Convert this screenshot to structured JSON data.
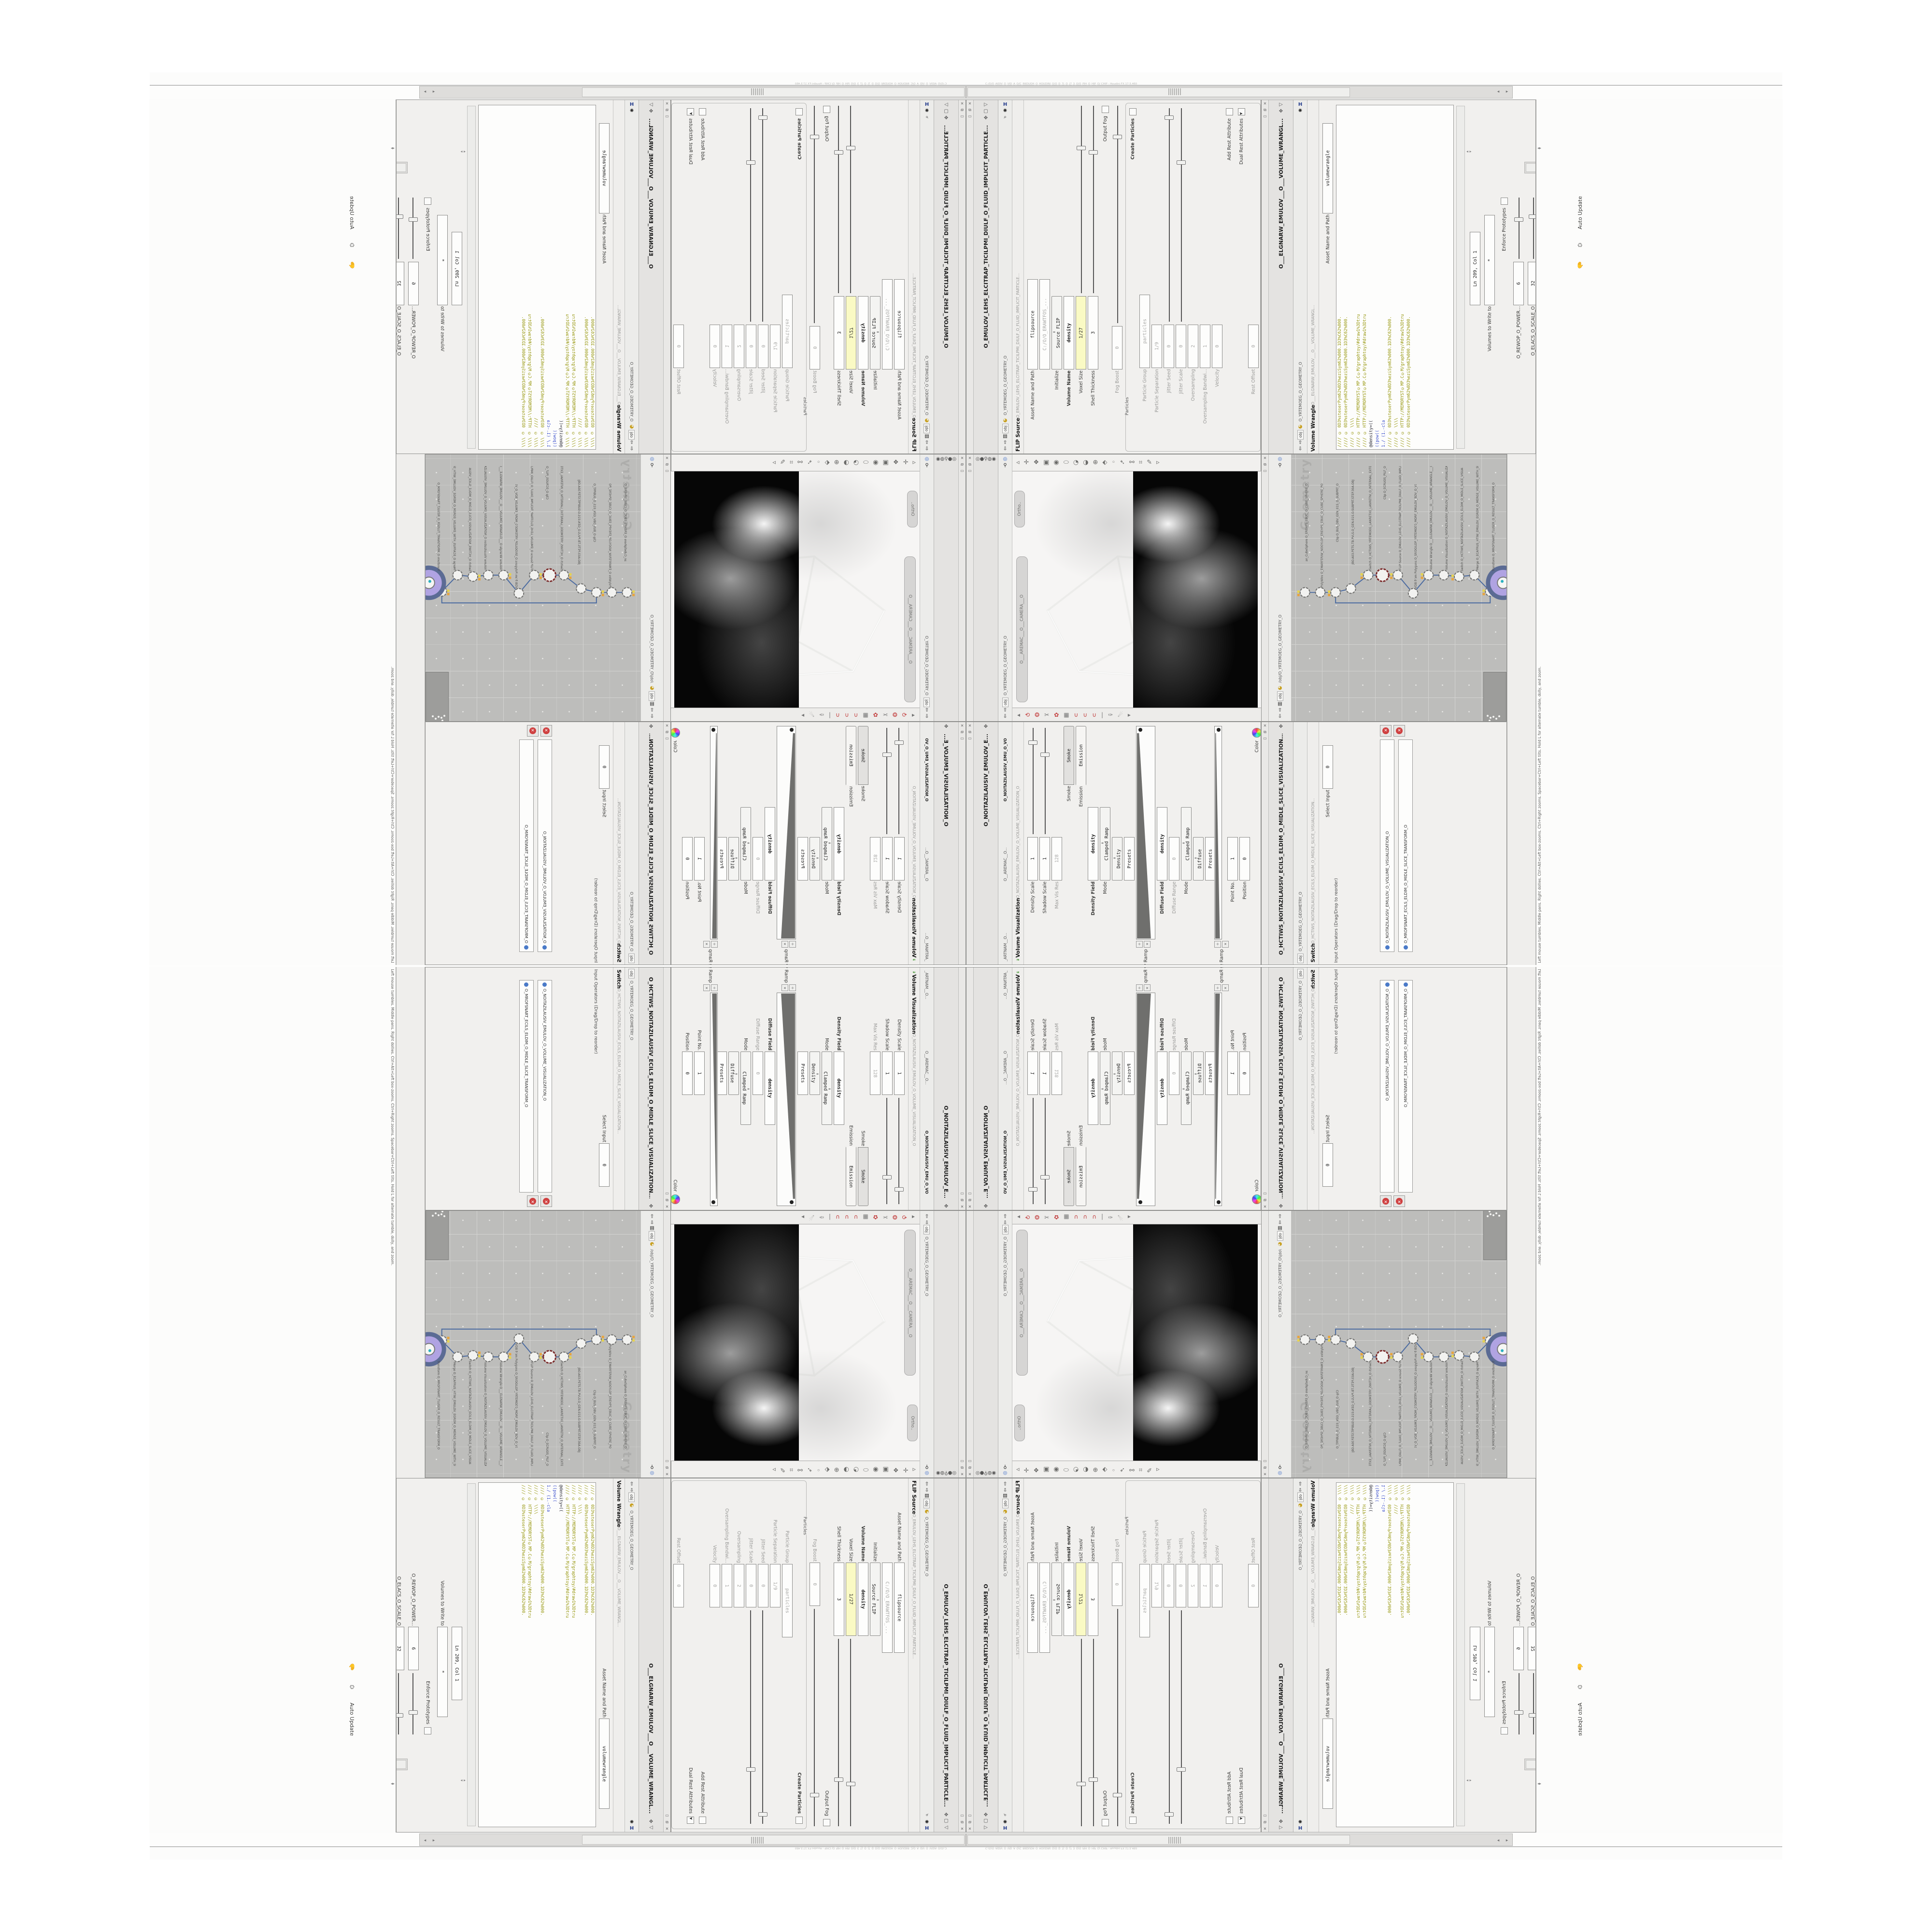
{
  "window": {
    "title": "C:/O/O_AIDIV_O_VID_A_O/C_INIDUOH_O_HOUDINI_O/O_D_7|_O_|7_3_O/O_PIH_O_HIP_O/ CHIP - Houdini FX 17.5.460",
    "auto_update": "Auto Update",
    "status_help": "Left mouse tumbles. Middle pans. Right dollies. Ctrl+Alt+Left box-zooms. Ctrl+Right zooms. Spacebar+Ctrl+Left tilts. Hold L for alternate tumble, dolly, and zoom.",
    "context": "obj",
    "geo_path": "O_YRTEMOEG_O_GEOMETRY_O",
    "net_path": "/obj/O_YRTEMOEG_O_GEOMETRY_O"
  },
  "flip": {
    "tab_long": "O_EMULOV_LEHS_ELCITRAP_TICILPMI_DIULF_O_FLUID_IMPLICIT_PARTICLE...",
    "node_title": "FLIP Source",
    "params_pre": [
      {
        "l": "Asset Name and Path",
        "v": "flipsource",
        "t": "tall"
      },
      {
        "l": "",
        "v": "C:/O/O_ERAWTFOS_...",
        "t": "tall dim"
      },
      {
        "l": "Initialize",
        "v": "Source FLIP",
        "t": "dd"
      },
      {
        "l": "Volume Name",
        "v": "density",
        "t": "b"
      },
      {
        "l": "Voxel Size",
        "v": "1/27",
        "t": "hl",
        "s": 1
      },
      {
        "l": "Shell Thickness",
        "v": "3",
        "t": "",
        "s": 1
      },
      {
        "l": "Output Fog",
        "v": "",
        "t": "chk"
      },
      {
        "l": "Fog Boost",
        "v": "0",
        "t": "dim short",
        "s": 1
      }
    ],
    "group_label": "Particles",
    "params_group": [
      {
        "l": "Create Particles",
        "v": "",
        "t": "chk b"
      },
      {
        "l": "Particle Group",
        "v": "particles",
        "t": "dim"
      },
      {
        "l": "Particle Separation",
        "v": "1/9",
        "t": "dim short"
      },
      {
        "l": "Jitter Seed",
        "v": "0",
        "t": "dim short",
        "s": 1
      },
      {
        "l": "Jitter Scale",
        "v": "0",
        "t": "dim short",
        "s": 1
      },
      {
        "l": "Oversampling",
        "v": "2",
        "t": "dim short"
      },
      {
        "l": "Oversampling Bandwi...",
        "v": "1",
        "t": "dim short"
      },
      {
        "l": "Velocity",
        "v": "0",
        "t": "dim short"
      },
      {
        "l": "Add Rest Attribute",
        "v": "",
        "t": "chk"
      },
      {
        "l": "Dual Rest Attributes",
        "v": "",
        "t": "chk on"
      },
      {
        "l": "Rest Offset",
        "v": "0",
        "t": "dim short"
      }
    ]
  },
  "wrangle": {
    "tab_long": "O___ELGNARW_EMULOV___O___VOLUME_WRANGL...",
    "node_title": "Volume Wrangle",
    "asset_field": {
      "l": "Asset Name and Path",
      "v": "volumewrangle",
      "t": "tall"
    },
    "code_lines": [
      {
        "t": "//// © 0D3%steserPym62%0D3%eziSym62%000.1D3%C62%000.",
        "c": ""
      },
      {
        "t": "//// © 0D3%steserPym62%0D3%eziSym62%000.1D3%C62%000.",
        "c": ""
      },
      {
        "t": "//// © \\\\\\\\",
        "c": ""
      },
      {
        "t": "//// © HTTP://MEMORYST©MP.C©M/graphtoy/#draw1%3Dtru",
        "c": ""
      },
      {
        "t": "//// © HTTP://MEMORYST©MP.C©M/graphtoy/#draw1%3Dtru",
        "c": ""
      },
      {
        "t": "@density=((",
        "c": "dark"
      },
      {
        "t": "((pow((",
        "c": "blue"
      },
      {
        "t": "1./ (1.-cla",
        "c": "blue"
      },
      {
        "t": "//// © 0D3%steserPym62%0D3%eziSym62%000.1D3%C62%000.",
        "c": ""
      },
      {
        "t": "//// © \\\\\\\\",
        "c": ""
      },
      {
        "t": "//// © HTTP://MEMORYST©MP.C©M/graphtoy/#draw1%3Dtru",
        "c": ""
      },
      {
        "t": "//// © 0D3%steserPym62%0D3%eziSym62%000.1D3%C62%000.",
        "c": ""
      }
    ],
    "cluster": [
      {
        "l": "",
        "v": "Ln 209, Col 1",
        "t": ""
      },
      {
        "l": "Volumes to Write to",
        "v": "*",
        "t": "tall"
      },
      {
        "l": "Enforce Prototypes",
        "v": "",
        "t": "chk"
      },
      {
        "l": "O_REWOP_O_POWER...",
        "v": "6",
        "t": "short",
        "s": 1
      },
      {
        "l": "O_ELACS_O_SCALE_O",
        "v": "32",
        "t": "short",
        "s": 1
      },
      {
        "l": "O_TFIHS_O_SHIFT_O",
        "v": "1.4375",
        "t": "short",
        "s": 1
      }
    ]
  },
  "volvis": {
    "tab_long": "O_NOITAZILAUSIV_EMULOV_E...",
    "tabs": [
      "O_NOITAZILAUSIV_EMU_O_VO",
      "O__AREMAC__O...",
      "_ARTNAM__O..."
    ],
    "node_title": "Volume Visualization",
    "params": [
      {
        "l": "Density Scale",
        "v": "1",
        "t": "short",
        "s": 1
      },
      {
        "l": "Shadow Scale",
        "v": "1",
        "t": "short",
        "s": 1
      },
      {
        "l": "Max Vis Res",
        "v": "128",
        "t": "dim short"
      },
      {
        "l": "Smoke",
        "v": "Smoke",
        "t": "tabw"
      },
      {
        "l": "Emission",
        "v": "Emission",
        "t": "tabw on"
      },
      {
        "l": "Density Field",
        "v": "density",
        "t": "b"
      },
      {
        "l": "Mode",
        "v": "Clamped Ramp",
        "t": "dd"
      },
      {
        "l": "",
        "v": "Density",
        "t": "dd short"
      },
      {
        "l": "",
        "v": "Presets",
        "t": "btn short"
      },
      {
        "l": "Density Ramp",
        "v": "",
        "t": "ramp"
      },
      {
        "l": "Diffuse Field",
        "v": "density",
        "t": "b"
      },
      {
        "l": "Diffuse Range",
        "v": "0",
        "t": "dim short"
      },
      {
        "l": "Mode",
        "v": "Clamped Ramp",
        "t": "dd"
      },
      {
        "l": "",
        "v": "Diffuse",
        "t": "dd short"
      },
      {
        "l": "",
        "v": "Presets",
        "t": "btn short"
      },
      {
        "l": "Diffuse Ramp",
        "v": "",
        "t": "ramp thin"
      },
      {
        "l": "Point No.",
        "v": "1",
        "t": "short"
      },
      {
        "l": "Position",
        "v": "0",
        "t": "short"
      },
      {
        "l": "Color",
        "v": "",
        "t": "color"
      },
      {
        "l": "",
        "v": "1.8125",
        "t": "short"
      },
      {
        "l": "",
        "v": "1.8125",
        "t": "short"
      },
      {
        "l": "Interpolation",
        "v": "Linear",
        "t": "dd"
      }
    ]
  },
  "switch": {
    "tab_long": "O_HCTIWS_NOITAZILAUSIV_ECILS_ELDIM_O_MIDLE_SLICE_VISUALIZATION...",
    "node_title": "Switch",
    "select_input": {
      "l": "Select Input",
      "v": "0",
      "t": "short"
    },
    "ops_label": "Input Operators (Drag/Drop to reorder)",
    "items": [
      "O_NOITAZILAUSIV_EMULOV_O_VOLUME_VISUALIZATION_O",
      "O_MROFSNART_ECILS_ELDIM_O_MIDLE_SLICE_TRANSFORM_O"
    ]
  },
  "network": {
    "watermark": "Geometry",
    "node_labels": [
      "an_CubeSphere  O_EREHPS_EBUC_O_CUBE_SPHERE_O",
      "PolyWire  O_EMARFERIW_NOGYLOP_EREHPS_EBUC_O_CUBE_SPHERE_POLYGON_WIREFRAME_O",
      "Clip  O_BUS_DBV_GEN_01S_O_SUBPRT_O",
      "JBO.A03.PETS.TB.PVLS.O_GEN.01S.O.SUBPRT.STEP.30A.OBJ",
      "Switch  O_HCTIWS_YRTEMOEG_LANRETXE_LANRETNI_O_INTERNAL_EXTERNAL_GEOMETRY_SWITCH_O",
      "Clip  O_ECRUOS_PILF_O",
      "FLIP Source  O_EMULOV_LEHS_ELCITRAP_TICILPMI_DIULF_O_FLUID_IMPLICIT_PARTICLE_SHEL_VOLUME",
      "VDB from Polygons  O_SNOGILOP_YRTEMOEG_MORF_EMULOV_BDV_O_VDB_VOLUME_FROM_GEOMETRY_POLYG",
      "Volume Wrangle  O___ELGNARW_EMULOV___O___VOLUME_WRANGLE___O",
      "Volume Visualization  O_NOITAZILAUSIV_EMULOV_O_VOLUME_VISUALIZATION_O",
      "Switch  O_HCTIWS_NOITAZILAUSIV_ECILS_ELDIM_O_MIDLE_SLICE_VISUALIZATION_SWITCH_O",
      "Merge  O_ECAFRUS_HTIW_EMULOV_EGREM_O_MERGE_VOLUME_WITH_SURFACE_O",
      "Transform  O_MROFSNART_TLUSER_O_RESULT_TRANSFORM_O"
    ]
  },
  "viewport": {
    "camera_pill": "O___AREMAC___O___CAMERA___O",
    "ortho_pill": "Ortho..",
    "top_icons": [
      "◃",
      "✛",
      "❖",
      "▣",
      "◉",
      "⬭",
      "◔",
      "◑",
      "⊕",
      "⬖",
      "◦",
      "➴",
      "⚯",
      "⌗",
      "✎",
      "▹"
    ],
    "bottom_icons": [
      {
        "g": "◂",
        "c": ""
      },
      {
        "g": "⟲",
        "c": "red"
      },
      {
        "g": "❂",
        "c": "red"
      },
      {
        "g": "✂",
        "c": ""
      },
      {
        "g": "✿",
        "c": "red"
      },
      {
        "g": "▦",
        "c": ""
      },
      {
        "g": "∪",
        "c": "red"
      },
      {
        "g": "∪",
        "c": "red"
      },
      {
        "g": "∪",
        "c": "red"
      },
      {
        "g": "|",
        "c": ""
      },
      {
        "g": "✑",
        "c": ""
      },
      {
        "g": "☄",
        "c": ""
      },
      {
        "g": "▸",
        "c": ""
      }
    ]
  },
  "icons": {
    "pane_buttons": [
      "✕",
      "⧉",
      "▭"
    ],
    "tab_top": [
      "▷",
      "▢",
      "✥"
    ],
    "pathbar": {
      "houdini": "H",
      "gear": "✺",
      "magnify": "⌕",
      "logo": "◕",
      "film": "▤",
      "chip": "obj",
      "up": "⇧",
      "down": "⇩"
    },
    "view_strip": [
      "◎",
      "●",
      "⚲",
      "◍",
      "◉"
    ]
  },
  "colors": {
    "code_olive": "#96960c",
    "code_blue": "#3a4ecc",
    "field_highlight": "#fafac4",
    "network_bg": "#bdbdbb",
    "viewport_black": "#060606",
    "node_purple": "#b0a3e2",
    "node_purple_ring": "#5b6b94",
    "flag_yellow": "#e8d44c",
    "red_x": "#cf4040",
    "wire_blue": "#4a6aa0"
  }
}
